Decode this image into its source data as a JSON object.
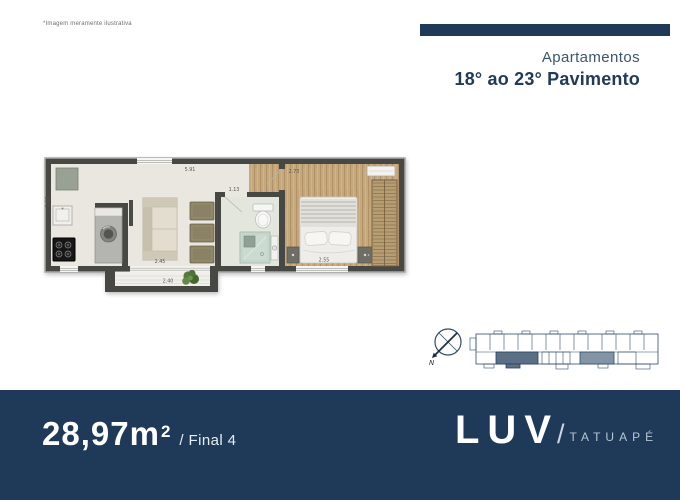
{
  "disclaimer": "*Imagem meramente ilustrativa",
  "header": {
    "subtitle": "Apartamentos",
    "title": "18° ao 23° Pavimento"
  },
  "plan": {
    "dimensions": {
      "top_width": "5.91",
      "hall_width": "1.13",
      "bedroom_width": "2.73",
      "living_width": "2.45",
      "balcony_width": "2.40",
      "bed_width": "2.55",
      "kitchen_depth": "2.08"
    }
  },
  "compass": {
    "north_label": "N"
  },
  "footer": {
    "area_value": "28,97m",
    "area_exponent": "2",
    "unit_label": "/ Final 4"
  },
  "logo": {
    "brand": "LUV",
    "separator": "/",
    "location": "TATUAPÉ"
  },
  "colors": {
    "navy": "#1e3a58",
    "logo_location": "#b6c5d3",
    "wall": "#474744",
    "floor": "#eae7e0",
    "wood": "#c5a87c"
  }
}
